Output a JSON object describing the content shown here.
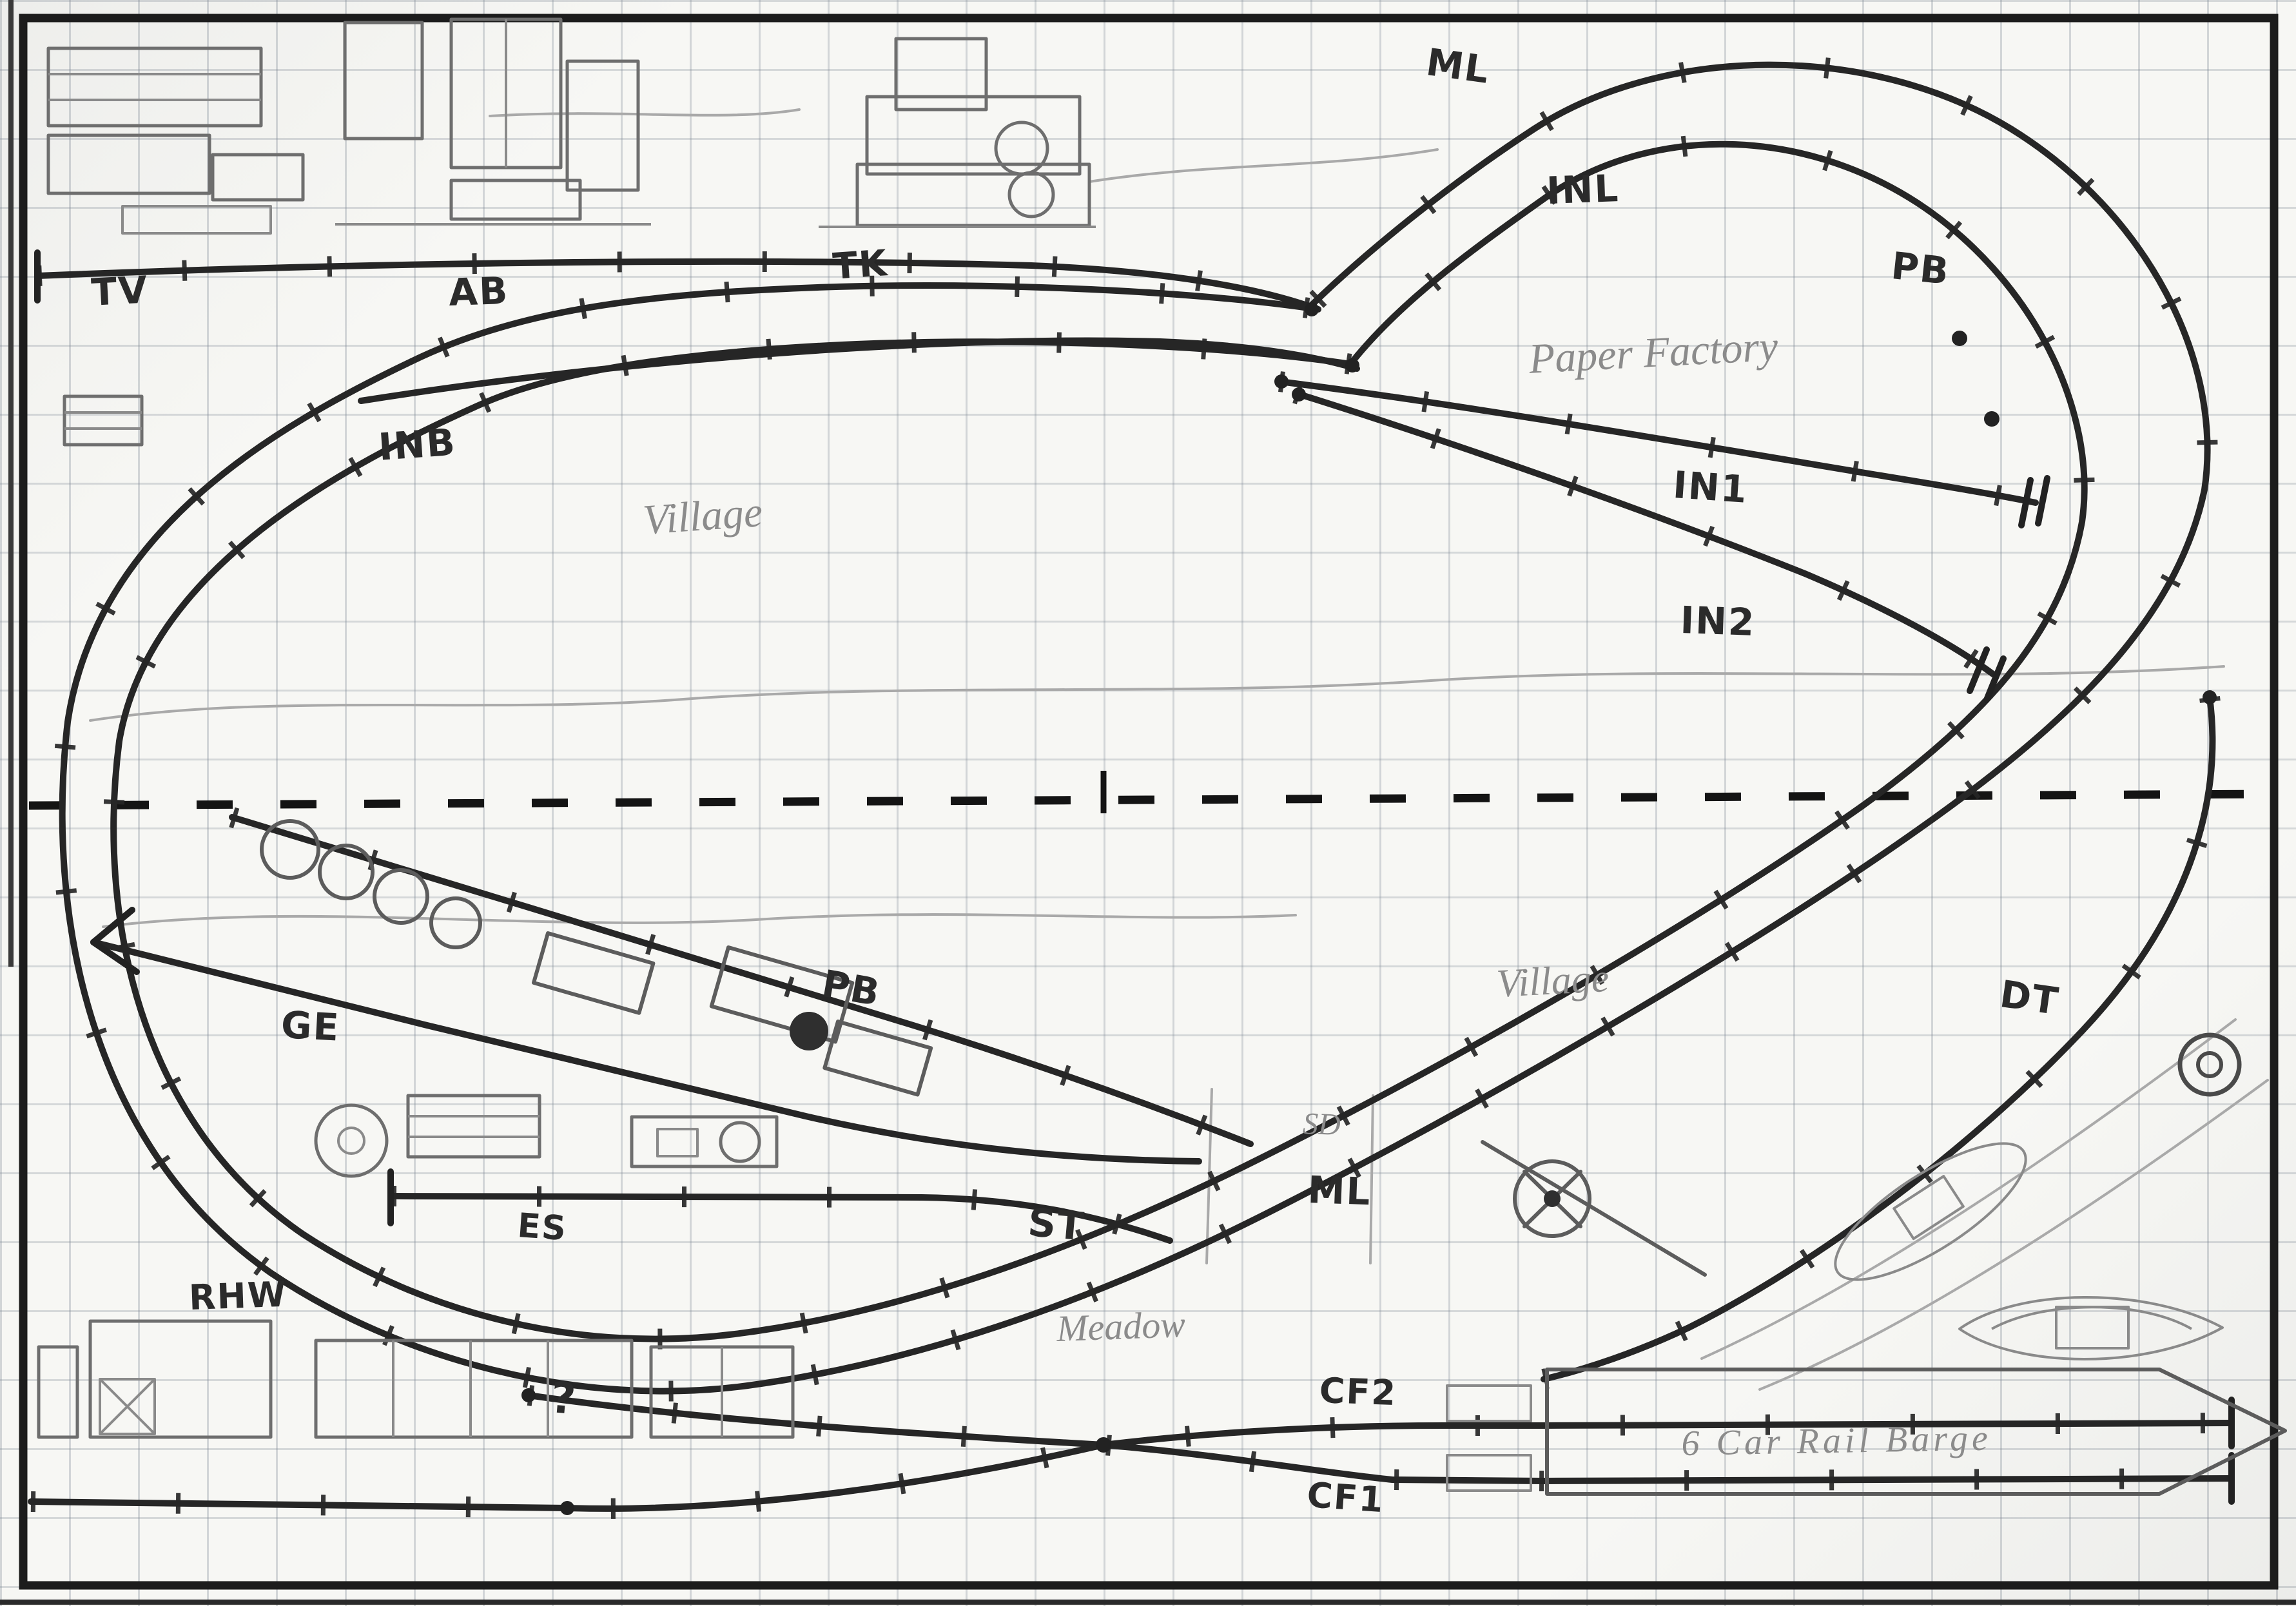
{
  "title": "Hand-drawn model railway track plan sketch",
  "colors": {
    "ink": "#262626",
    "pencil": "#8b8b8b",
    "grid": "#7d8794",
    "paper": "#f7f7f4"
  },
  "labels": [
    {
      "id": "tv",
      "text": "TV",
      "style": "ink"
    },
    {
      "id": "ab",
      "text": "AB",
      "style": "ink"
    },
    {
      "id": "tk",
      "text": "TK",
      "style": "ink"
    },
    {
      "id": "ml-top",
      "text": "ML",
      "style": "ink"
    },
    {
      "id": "inl",
      "text": "INL",
      "style": "ink"
    },
    {
      "id": "pb-top",
      "text": "PB",
      "style": "ink"
    },
    {
      "id": "inb",
      "text": "INB",
      "style": "ink"
    },
    {
      "id": "village-top",
      "text": "Village",
      "style": "pencil"
    },
    {
      "id": "paper-factory",
      "text": "Paper Factory",
      "style": "pencil"
    },
    {
      "id": "in1",
      "text": "IN1",
      "style": "ink"
    },
    {
      "id": "in2",
      "text": "IN2",
      "style": "ink"
    },
    {
      "id": "ge",
      "text": "GE",
      "style": "ink"
    },
    {
      "id": "pb-mid",
      "text": "PB",
      "style": "ink"
    },
    {
      "id": "village-low",
      "text": "Village",
      "style": "pencil"
    },
    {
      "id": "dt",
      "text": "DT",
      "style": "ink"
    },
    {
      "id": "sd",
      "text": "SD",
      "style": "pencil"
    },
    {
      "id": "ml-low",
      "text": "ML",
      "style": "ink"
    },
    {
      "id": "es",
      "text": "ES",
      "style": "ink"
    },
    {
      "id": "st",
      "text": "ST",
      "style": "ink"
    },
    {
      "id": "rhw",
      "text": "RHW",
      "style": "ink"
    },
    {
      "id": "meadow",
      "text": "Meadow",
      "style": "pencil"
    },
    {
      "id": "cf2",
      "text": "CF2",
      "style": "ink"
    },
    {
      "id": "cf1",
      "text": "CF1",
      "style": "ink"
    },
    {
      "id": "rail-barge",
      "text": "6 Car Rail Barge",
      "style": "pencil"
    },
    {
      "id": "question",
      "text": "?",
      "style": "ink"
    }
  ]
}
